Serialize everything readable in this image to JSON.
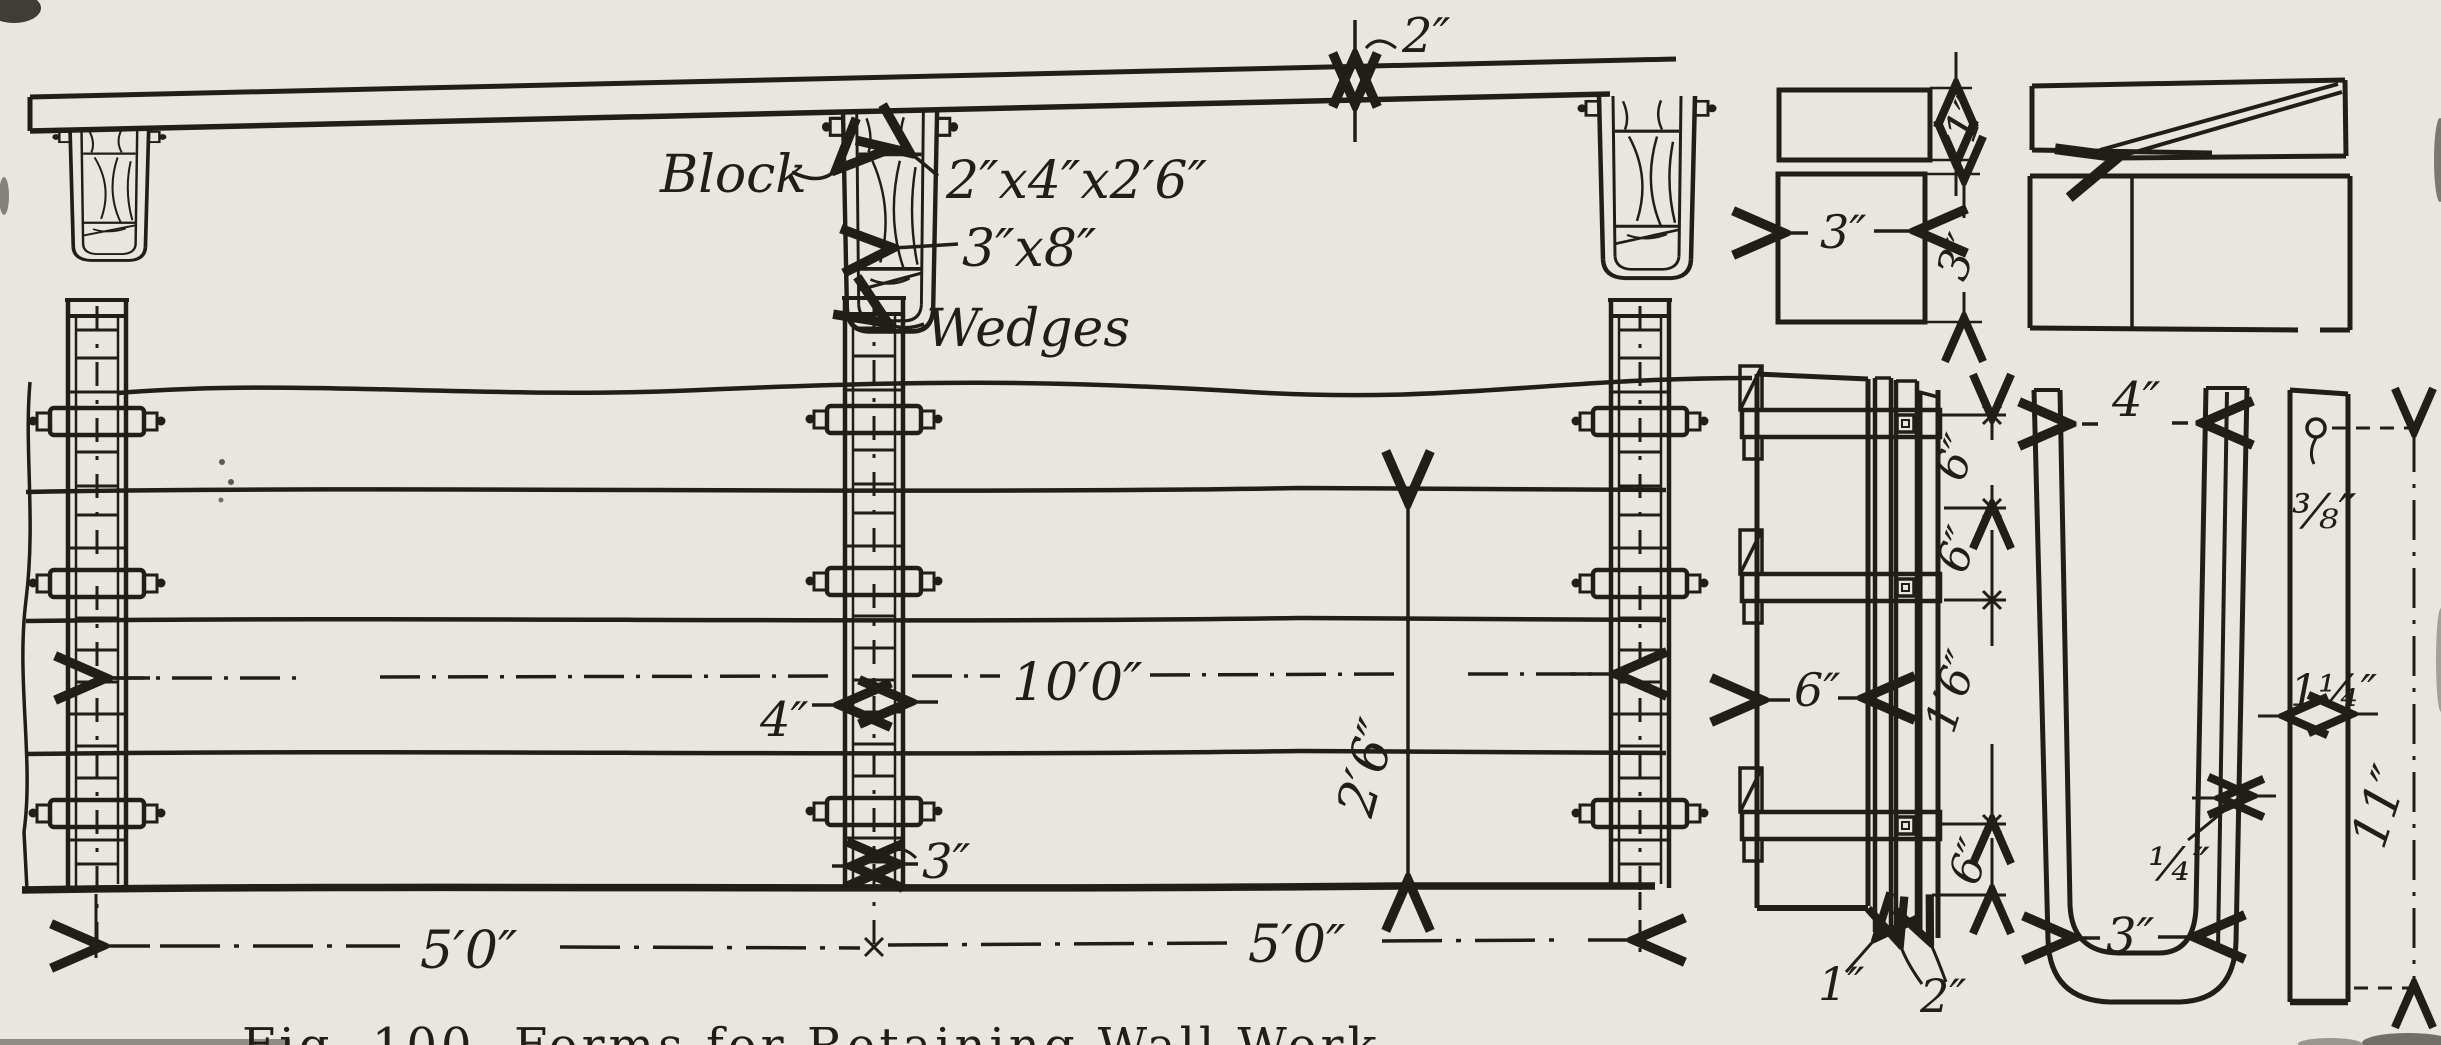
{
  "figure": {
    "caption": "Fig. 100.  Forms for Retaining Wall Work",
    "ink_color": "#211e1a",
    "paper_color": "#e9e6e0"
  },
  "labels": {
    "block": "Block",
    "block_size": "2″x4″x2′6″",
    "wale_size": "3″x8″",
    "wedges": "Wedges"
  },
  "dimensions": {
    "plank_thickness": "2″",
    "wedge_thickness": "1″",
    "wedge_width": "3″",
    "wedge_height": "3″",
    "post_width": "4″",
    "post_span_total": "10′0″",
    "post_foot_width": "3″",
    "depth_below_line": "2′6″",
    "bay_left": "5′0″",
    "bay_right": "5′0″",
    "panel_board_width": "6″",
    "chain_top": "6″",
    "chain_second": "6″",
    "chain_middle": "1′6″",
    "chain_bottom": "6″",
    "strip_one": "1″",
    "strip_two": "2″",
    "clamp_opening": "4″",
    "hole_diameter": "⅜″",
    "bar_width": "1¼″",
    "liner_thickness": "¼″",
    "clamp_inside_width": "3″",
    "bar_length": "11″"
  }
}
